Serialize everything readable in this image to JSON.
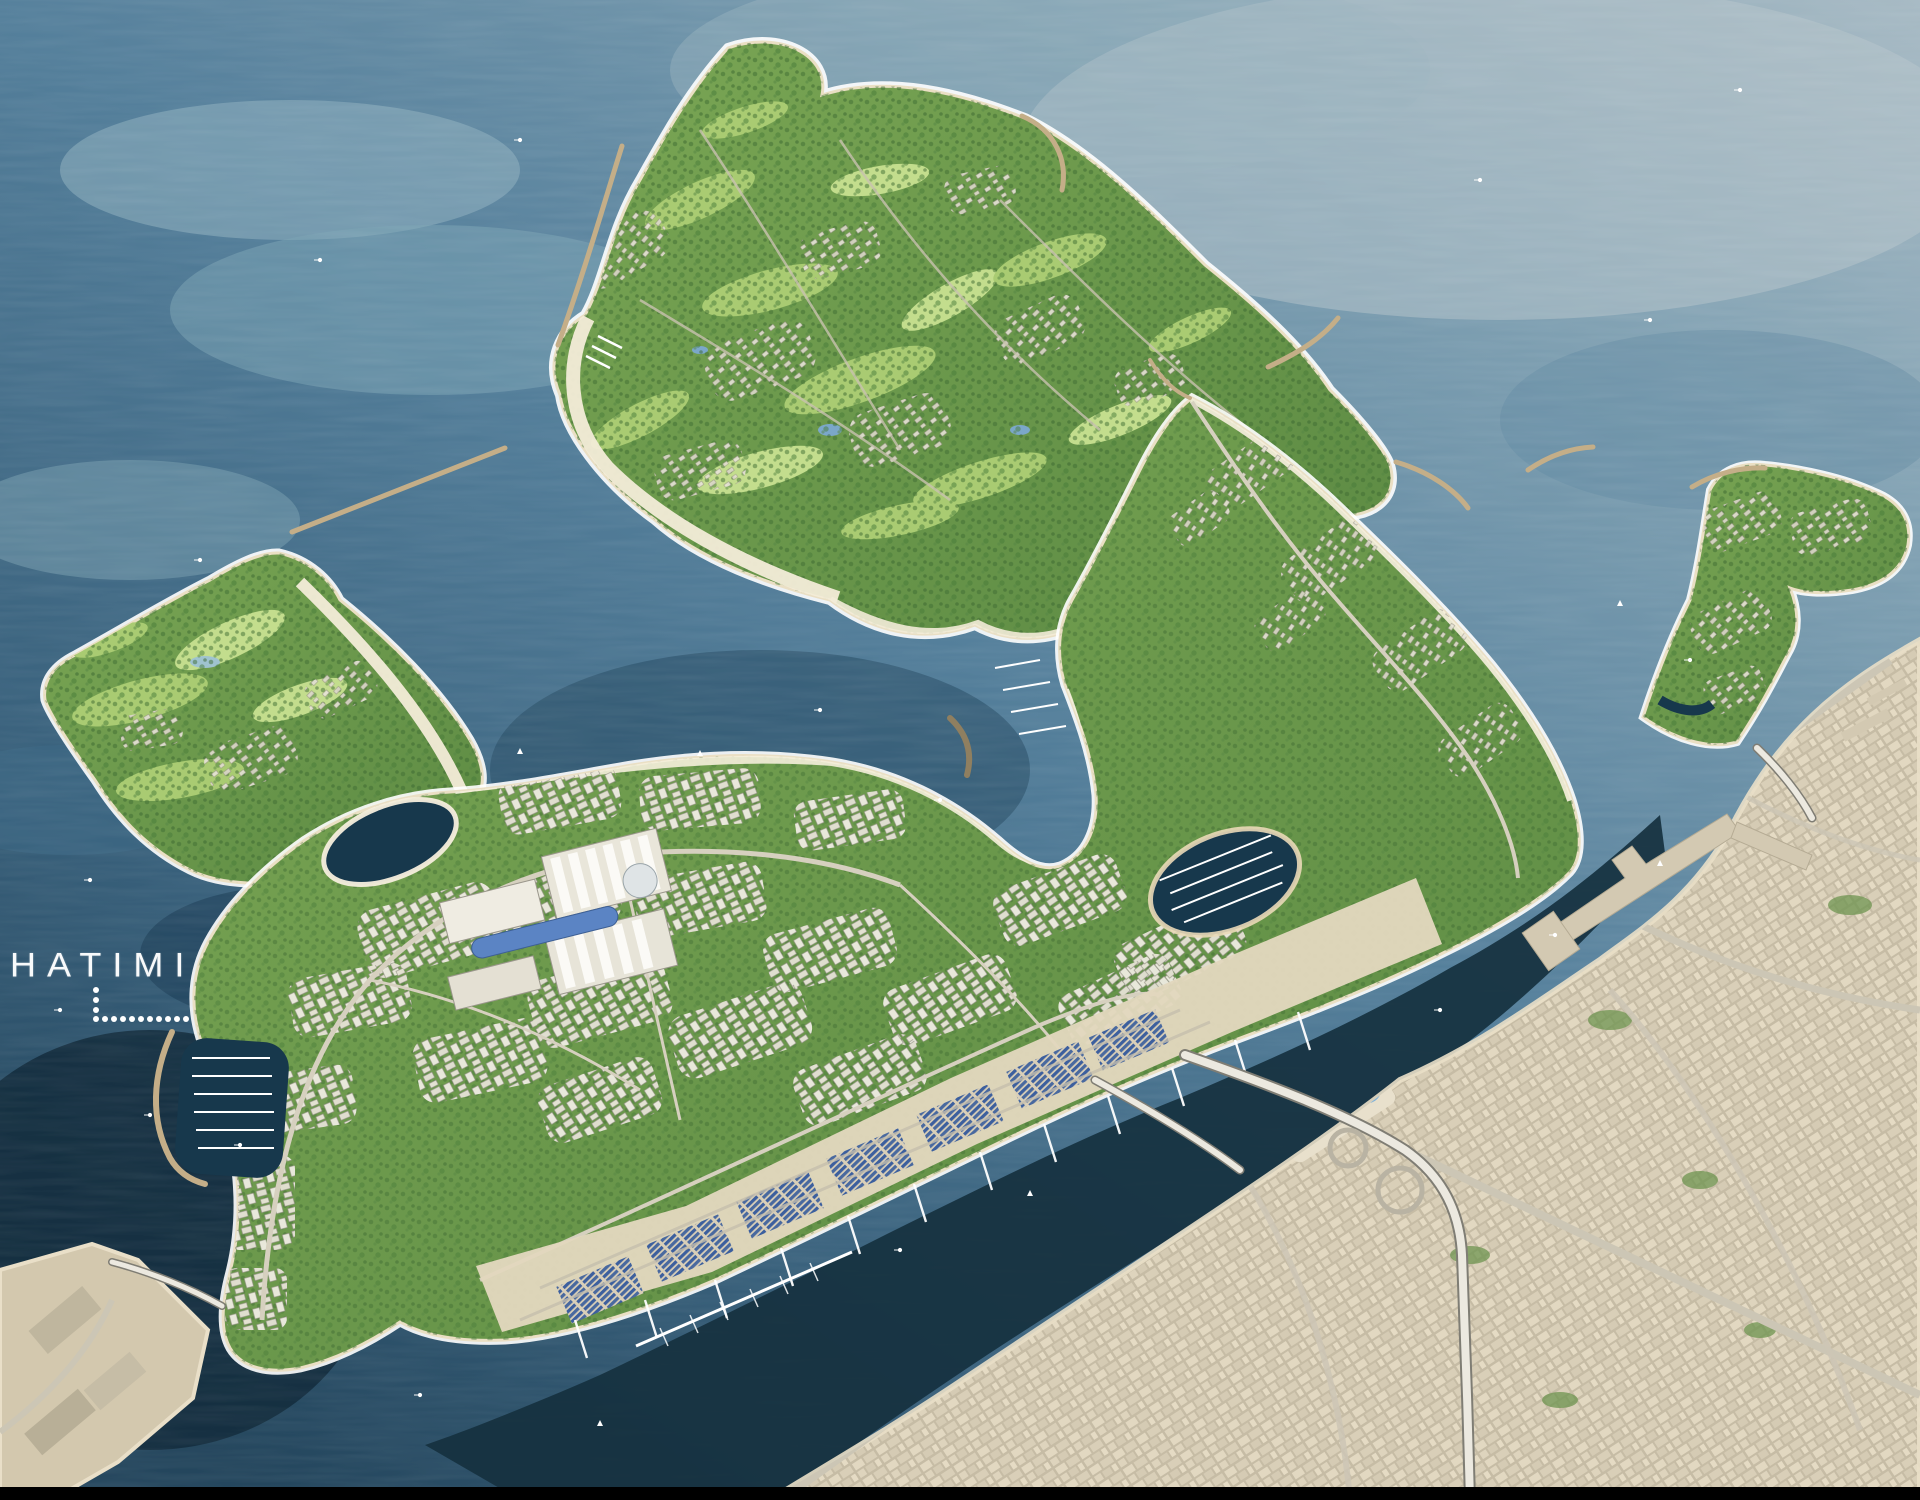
{
  "scene": {
    "type": "aerial-masterplan-render",
    "content": "Aerial rendering of coastal island development: golf-course islands, residential crescent island, urban marina district with souk waterfront, channel, and dense mainland city"
  },
  "watermark": {
    "text": "HATIMI",
    "color": "#ffffff"
  },
  "palette": {
    "ocean_haze": "#a7bac4",
    "ocean_light": "#7fa0b2",
    "ocean_mid": "#547f9b",
    "ocean_deep": "#39617c",
    "ocean_dark": "#24465d",
    "channel": "#16313f",
    "lagoon": "#17384c",
    "island_green": "#7aa654",
    "island_green_deep": "#5c8a43",
    "fairway": "#a9cb72",
    "fairway_light": "#c3dd8d",
    "tree_green": "#3f6c33",
    "sand": "#ead9b8",
    "beach": "#f6efdd",
    "city": "#d7ccb4",
    "road": "#ccc6b5",
    "highway": "#ece9e0",
    "souk_blue": "#3f62a2",
    "breakwater": "#c4ae88",
    "boat": "#ffffff",
    "watermark": "#ffffff",
    "black_bar": "#000000"
  }
}
